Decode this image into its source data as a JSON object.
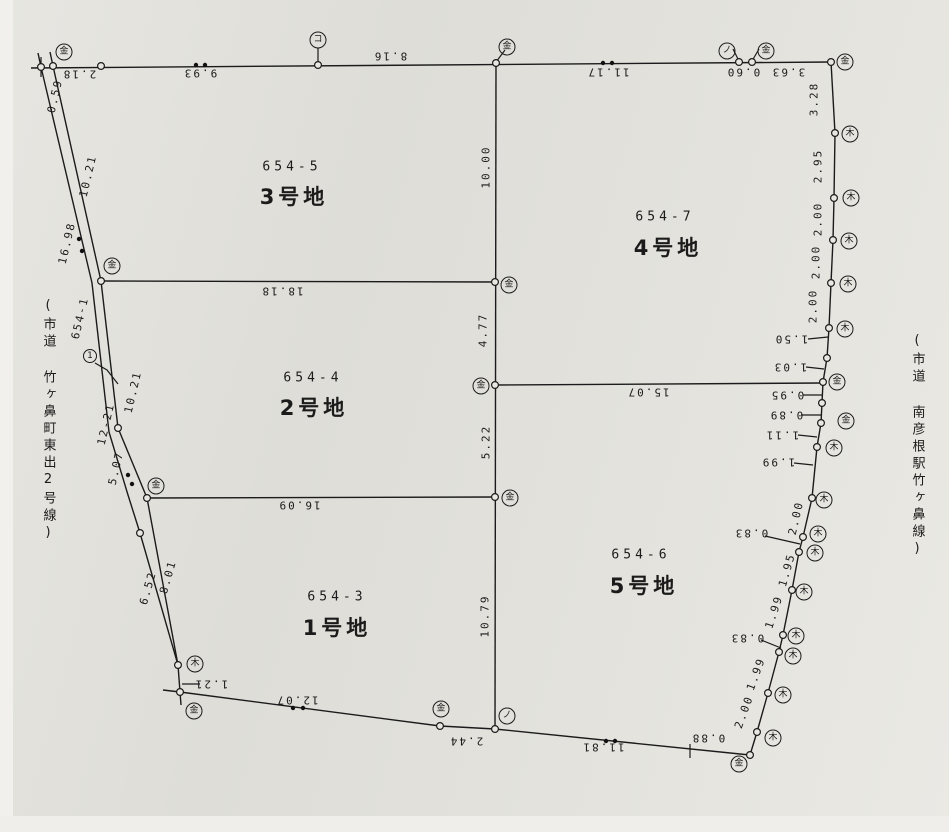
{
  "map": {
    "title": "land subdivision survey drawing",
    "lots": [
      {
        "parcel": "654-5",
        "label": "3号地"
      },
      {
        "parcel": "654-7",
        "label": "4号地"
      },
      {
        "parcel": "654-4",
        "label": "2号地"
      },
      {
        "parcel": "654-3",
        "label": "1号地"
      },
      {
        "parcel": "654-6",
        "label": "5号地"
      }
    ],
    "roads": {
      "left_name": "(市道 竹ヶ鼻町東出2号線)",
      "right_name": "(市道 南彦根駅竹ヶ鼻線)",
      "road_parcel": "654-1",
      "point_no": "1"
    },
    "markers": {
      "metal": "金",
      "wood": "木",
      "concrete": "コ",
      "slash": "ノ"
    },
    "dims": {
      "top": [
        "2.18",
        "9.93",
        "8.16",
        "11.17",
        "0.60",
        "3.63"
      ],
      "right": [
        "3.28",
        "2.95",
        "2.00",
        "2.00",
        "2.00",
        "1.50",
        "1.03",
        "0.95",
        "0.89",
        "1.11",
        "1.99",
        "2.00",
        "0.83",
        "1.95",
        "1.99",
        "0.83",
        "1.99",
        "2.00",
        "0.88"
      ],
      "bottom": [
        "11.81",
        "2.44",
        "12.07",
        "1.21"
      ],
      "left": [
        "0.59",
        "10.21",
        "16.98",
        "10.21",
        "12-21",
        "5.07",
        "6.52",
        "8.01"
      ],
      "center": [
        "10.00",
        "4.77",
        "5.22",
        "10.79"
      ],
      "cross": [
        "18.18",
        "15.07",
        "16.09"
      ]
    }
  }
}
